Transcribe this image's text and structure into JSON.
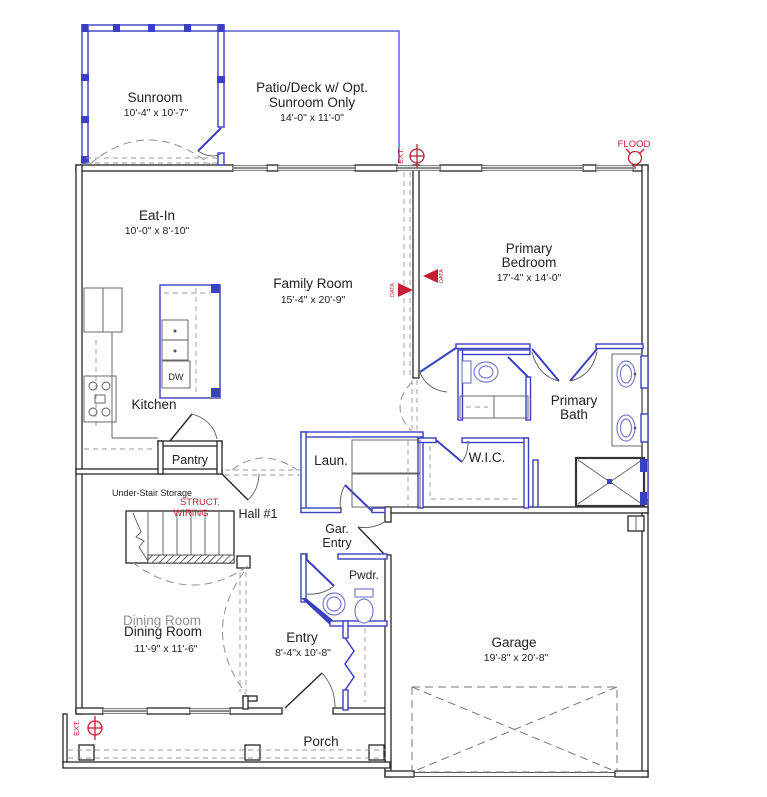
{
  "rooms": {
    "sunroom": {
      "name": "Sunroom",
      "dims": "10'-4\" x 10'-7\""
    },
    "patio": {
      "line1": "Patio/Deck w/ Opt.",
      "line2": "Sunroom Only",
      "dims": "14'-0\" x 11'-0\""
    },
    "eatin": {
      "name": "Eat-In",
      "dims": "10'-0\" x 8'-10\""
    },
    "family": {
      "name": "Family Room",
      "dims": "15'-4\" x 20'-9\""
    },
    "bedroom": {
      "line1": "Primary",
      "line2": "Bedroom",
      "dims": "17'-4\" x 14'-0\""
    },
    "kitchen": {
      "name": "Kitchen"
    },
    "pantry": {
      "name": "Pantry"
    },
    "dw": {
      "name": "DW"
    },
    "laundry": {
      "name": "Laun."
    },
    "wic": {
      "name": "W.I.C."
    },
    "bath": {
      "line1": "Primary",
      "line2": "Bath"
    },
    "hall1": {
      "name": "Hall #1"
    },
    "storage": {
      "name": "Under-Stair Storage"
    },
    "garentry": {
      "line1": "Gar.",
      "line2": "Entry"
    },
    "powder": {
      "name": "Pwdr."
    },
    "dining": {
      "name": "Dining Room",
      "dims": "11'-9\" x 11'-6\""
    },
    "entry": {
      "name": "Entry",
      "dims": "8'-4\"x 10'-8\""
    },
    "garage": {
      "name": "Garage",
      "dims": "19'-8\" x 20'-8\""
    },
    "porch": {
      "name": "Porch"
    }
  },
  "annotations": {
    "flood": "FLOOD",
    "ext_top": "EXT.",
    "ext_bottom": "EXT.",
    "struct_line1": "STRUCT.",
    "struct_line2": "WIRING",
    "data_left": "DATA",
    "data_right": "DATA"
  },
  "colors": {
    "wall": "#262626",
    "blue": "#3a40c2",
    "red": "#c41f33",
    "dash": "#9a9a9a"
  }
}
